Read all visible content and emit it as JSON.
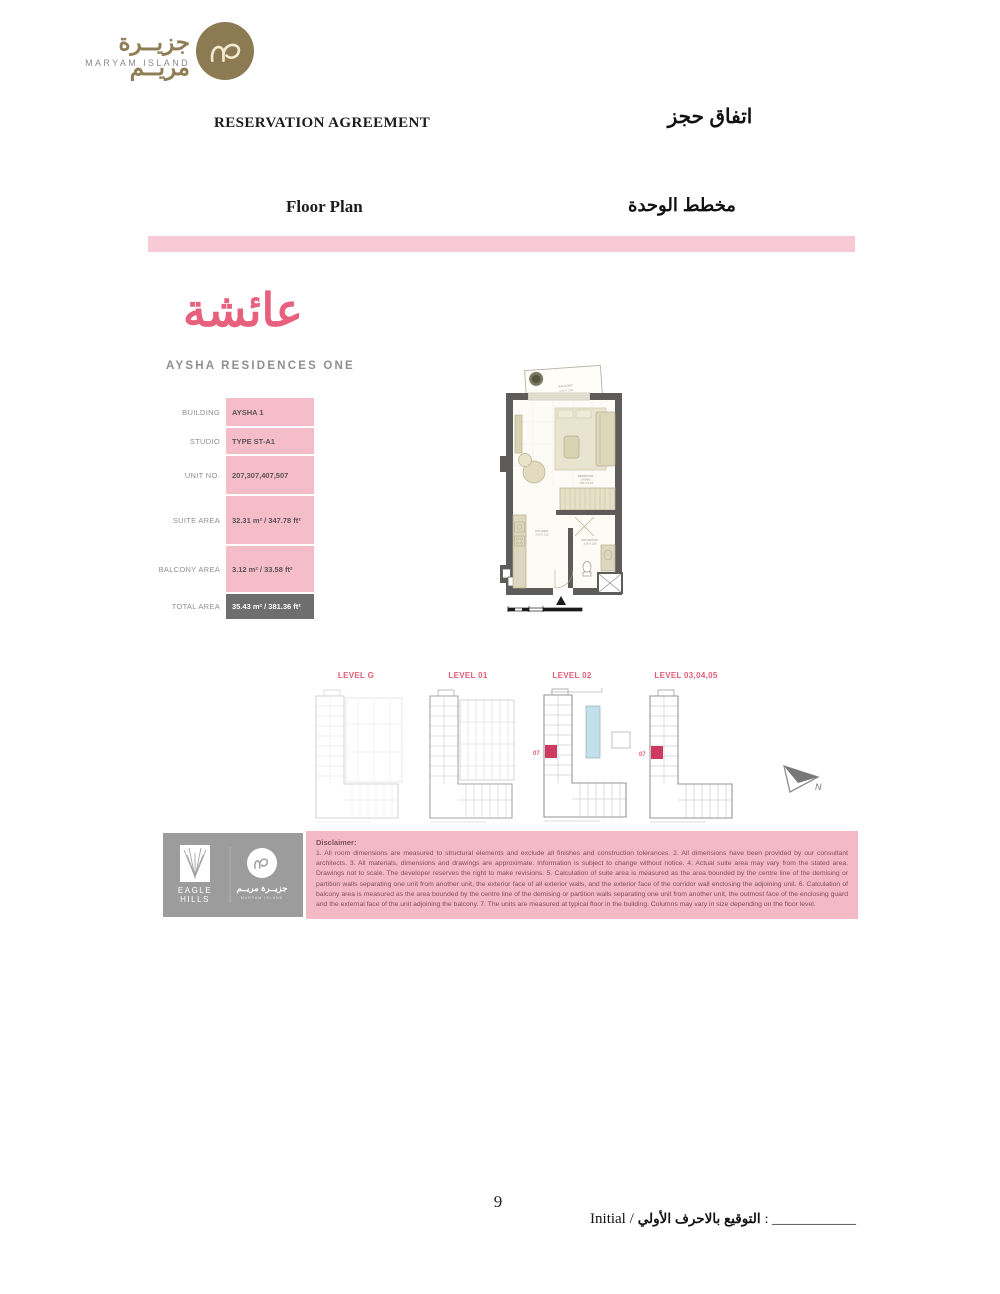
{
  "brand": {
    "name_ar": "جزيــرة مريــم",
    "name_en": "MARYAM ISLAND"
  },
  "header": {
    "title_en": "RESERVATION AGREEMENT",
    "title_ar": "اتفاق حجز",
    "section_en": "Floor Plan",
    "section_ar": "مخطط الوحدة"
  },
  "residence": {
    "name_ar": "عائشة",
    "name_en": "AYSHA RESIDENCES ONE"
  },
  "unit_table": {
    "rows": [
      {
        "label": "BUILDING",
        "value": "AYSHA 1"
      },
      {
        "label": "STUDIO",
        "value": "TYPE ST-A1"
      },
      {
        "label": "UNIT NO.",
        "value": "207,307,407,507"
      },
      {
        "label": "SUITE AREA",
        "value": "32.31 m² / 347.78 ft²"
      },
      {
        "label": "BALCONY AREA",
        "value": "3.12 m² / 33.58 ft²"
      },
      {
        "label": "TOTAL AREA",
        "value": "35.43 m² / 381.36 ft²"
      }
    ]
  },
  "floor_plan": {
    "rooms": {
      "balcony": {
        "name": "BALCONY",
        "dim": "2.46 X 1.26"
      },
      "bedroom_living": {
        "line1": "BEDROOM",
        "line2": "LIVING",
        "dim": "3.96 X 5.04"
      },
      "kitchen": {
        "name": "KITCHEN",
        "dim": "2.04 X 2.26"
      },
      "bathroom": {
        "name": "BATHROOM",
        "dim": "2.16 X 1.56"
      }
    }
  },
  "levels": {
    "items": [
      {
        "label": "LEVEL G"
      },
      {
        "label": "LEVEL 01"
      },
      {
        "label": "LEVEL 02",
        "unit": "07"
      },
      {
        "label": "LEVEL 03,04,05",
        "unit": "07"
      }
    ],
    "north": "N"
  },
  "disclaimer": {
    "title": "Disclaimer:",
    "body": "1. All room dimensions are measured to structural elements and exclude all finishes and construction tolerances. 2. All dimensions have been provided by our consultant architects. 3. All materials, dimensions and drawings are approximate. Information is subject to change without notice. 4. Actual suite area may vary from the stated area. Drawings not to scale. The developer reserves the right to make revisions. 5. Calculation of suite area is measured as the area bounded by the centre line of the demising or partition walls separating one unit from another unit, the exterior face of all exterior walls, and the exterior face of the corridor wall enclosing the adjoining unit. 6. Calculation of balcony area is measured as the area bounded by the centre line of the demising or partition walls separating one unit from another unit, the outmost face of the enclosing guard and the external face of the unit adjoining the balcony. 7. The units are measured at typical floor in the building. Columns may vary in size depending on the floor level."
  },
  "footer_logos": {
    "eagle_line1": "EAGLE",
    "eagle_line2": "HILLS",
    "maryam_ar": "جزيــرة مريــم",
    "maryam_en": "MARYAM ISLAND"
  },
  "footer": {
    "page_number": "9",
    "initial_en": "Initial /",
    "initial_ar": "التوقيع بالاحرف الأولي",
    "initial_blank": ": ____________"
  },
  "colors": {
    "brand_gold": "#8b7a52",
    "pink_bar": "#f8cad5",
    "pink_panel": "#f3b9c4",
    "table_pink": "#f5bdc8",
    "accent_pink": "#e7617e",
    "level_red": "#ce3960",
    "total_row_gray": "#6e6e6e",
    "wall_gray": "#5d5c5a",
    "footer_gray": "#9c9c9c"
  }
}
